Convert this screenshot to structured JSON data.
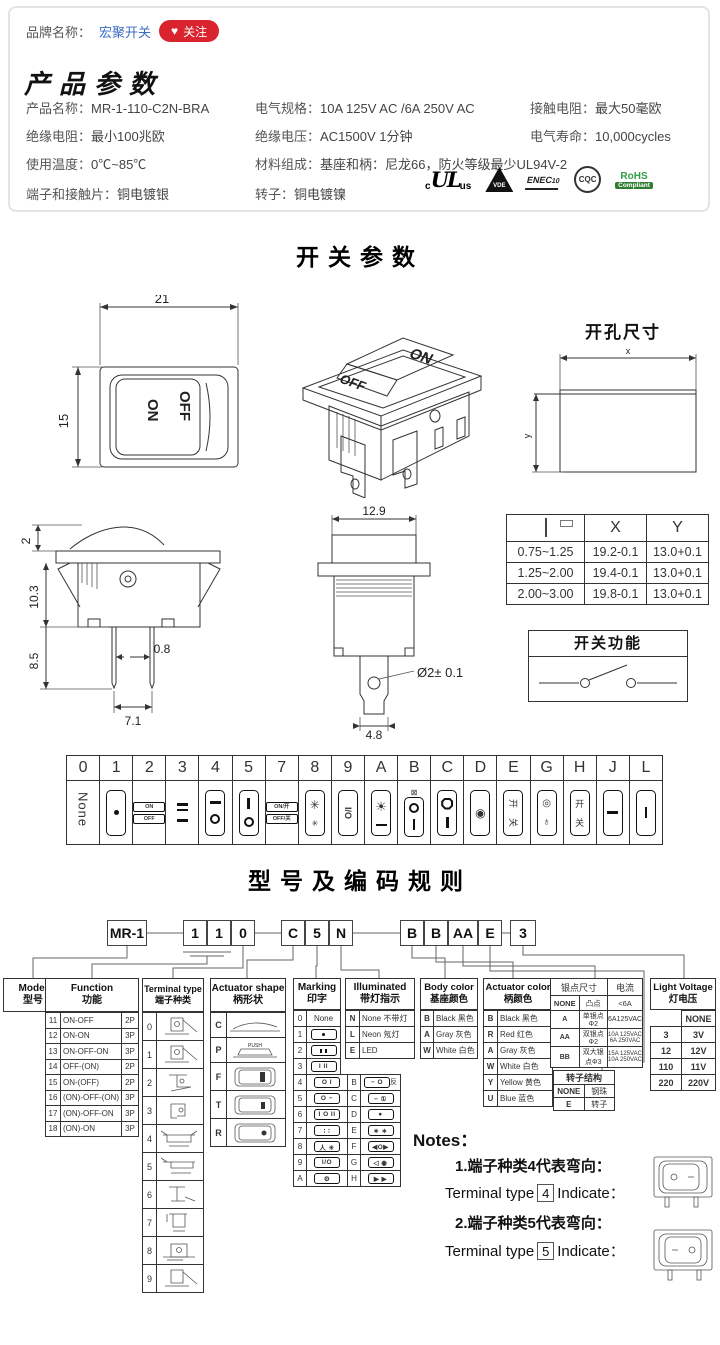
{
  "brand": {
    "label": "品牌名称：",
    "name": "宏聚开关",
    "heart": "♥",
    "follow": "关注"
  },
  "product": {
    "title": "产品参数",
    "specs": [
      {
        "label": "产品名称：",
        "value": "MR-1-110-C2N-BRA"
      },
      {
        "label": "电气规格：",
        "value": "10A 125V AC /6A 250V AC"
      },
      {
        "label": "接触电阻：",
        "value": "最大50毫欧"
      },
      {
        "label": "绝缘电阻：",
        "value": "最小100兆欧"
      },
      {
        "label": "绝缘电压：",
        "value": "AC1500V 1分钟"
      },
      {
        "label": "电气寿命：",
        "value": "10,000cycles"
      },
      {
        "label": "使用温度：",
        "value": "0℃~85℃"
      },
      {
        "label": "材料组成：",
        "value": "基座和柄：尼龙66，防火等级最少UL94V-2"
      },
      {
        "label": "端子和接触片：",
        "value": "铜电镀银"
      },
      {
        "label": "转子：",
        "value": "铜电镀镍"
      }
    ],
    "certs": {
      "c": "c",
      "ul": "UL",
      "us": "us",
      "vde": "VDE",
      "enec": "ENEC",
      "enec10": "10",
      "cqc": "CQC",
      "rohs": "RoHS",
      "compliant": "Compliant"
    }
  },
  "switch_section": {
    "title": "开关参数",
    "front": {
      "w": "21",
      "h": "15",
      "off": "OFF",
      "on": "ON"
    },
    "iso": {
      "on": "ON",
      "off": "OFF"
    },
    "hole": {
      "title": "开孔尺寸",
      "x": "x",
      "y": "y"
    },
    "side": {
      "d2": "2",
      "d103": "10.3",
      "d85": "8.5",
      "d08": "0.8",
      "d71": "7.1"
    },
    "front2": {
      "d129": "12.9",
      "dia": "Ø2± 0.1",
      "d48": "4.8"
    },
    "xy_table": {
      "hx": "X",
      "hy": "Y",
      "rows": [
        [
          "0.75~1.25",
          "19.2-0.1",
          "13.0+0.1"
        ],
        [
          "1.25~2.00",
          "19.4-0.1",
          "13.0+0.1"
        ],
        [
          "2.00~3.00",
          "19.8-0.1",
          "13.0+0.1"
        ]
      ]
    },
    "func_box": {
      "title": "开关功能"
    }
  },
  "marking_table": {
    "headers": [
      "0",
      "1",
      "2",
      "3",
      "4",
      "5",
      "7",
      "8",
      "9",
      "A",
      "B",
      "C",
      "D",
      "E",
      "G",
      "H",
      "J",
      "L"
    ],
    "none": "None",
    "on": "ON",
    "off": "OFF",
    "on7": "ON/开",
    "off7": "OFF/关",
    "fan_big": "✳",
    "fan_small": "✳",
    "io": "I/O",
    "bulb": "☀",
    "bmark": "⊠",
    "kai_rot": "开",
    "guan_rot": "关",
    "gdot": "◎",
    "lamp": "♁",
    "kai": "开",
    "guan": "关",
    "dcircle": "◉"
  },
  "coding": {
    "title": "型号及编码规则",
    "codes": {
      "model": "MR-1",
      "f1": "1",
      "f2": "1",
      "t": "0",
      "a": "C",
      "m": "5",
      "i": "N",
      "b": "B",
      "ac": "B",
      "s": "AA",
      "r": "E",
      "lv": "3"
    },
    "model": {
      "en": "Model",
      "zh": "型号"
    },
    "function": {
      "en": "Function",
      "zh": "功能",
      "rows": [
        [
          "11",
          "ON-OFF",
          "2P"
        ],
        [
          "12",
          "ON-ON",
          "3P"
        ],
        [
          "13",
          "ON-OFF-ON",
          "3P"
        ],
        [
          "14",
          "OFF-(ON)",
          "2P"
        ],
        [
          "15",
          "ON-(OFF)",
          "2P"
        ],
        [
          "16",
          "(ON)-OFF-(ON)",
          "3P"
        ],
        [
          "17",
          "(ON)-OFF-ON",
          "3P"
        ],
        [
          "18",
          "(ON)-ON",
          "3P"
        ]
      ]
    },
    "terminal": {
      "en": "Terminal type",
      "zh": "端子种类",
      "codes": [
        "0",
        "1",
        "2",
        "3",
        "4",
        "5",
        "6",
        "7",
        "8",
        "9"
      ]
    },
    "shape": {
      "en": "Actuator shape",
      "zh": "柄形状",
      "codes": [
        "C",
        "P",
        "F",
        "T",
        "R"
      ],
      "push": "PUSH"
    },
    "marking": {
      "en": "Marking",
      "zh": "印字",
      "rows1": [
        [
          "0",
          "None"
        ],
        [
          "1",
          ""
        ],
        [
          "2",
          ""
        ],
        [
          "3",
          "I II"
        ]
      ],
      "rows2": [
        [
          "4",
          "O I",
          "B",
          "− O",
          "反"
        ],
        [
          "5",
          "O −",
          "C",
          "− ①",
          ""
        ],
        [
          "6",
          "I O II",
          "D",
          "●",
          ""
        ],
        [
          "7",
          "∶ ∶",
          "E",
          "∗ ∗",
          ""
        ],
        [
          "8",
          "人 ✳",
          "F",
          "◀O▶",
          ""
        ],
        [
          "9",
          "I/O",
          "G",
          "◁ ◉",
          ""
        ],
        [
          "A",
          "⚙",
          "H",
          "▶ ▶",
          ""
        ]
      ]
    },
    "illuminated": {
      "en": "Illuminated",
      "zh": "带灯指示",
      "rows": [
        [
          "N",
          "None 不带灯"
        ],
        [
          "L",
          "Neon 氖灯"
        ],
        [
          "E",
          "LED"
        ]
      ]
    },
    "body_color": {
      "en": "Body color",
      "zh": "基座颜色",
      "rows": [
        [
          "B",
          "Black 黑色"
        ],
        [
          "A",
          "Gray 灰色"
        ],
        [
          "W",
          "White 白色"
        ]
      ]
    },
    "actuator_color": {
      "en": "Actuator color",
      "zh": "柄颜色",
      "rows": [
        [
          "B",
          "Black 黑色"
        ],
        [
          "R",
          "Red 红色"
        ],
        [
          "A",
          "Gray 灰色"
        ],
        [
          "W",
          "White 白色"
        ],
        [
          "Y",
          "Yellow 黄色"
        ],
        [
          "U",
          "Blue 蓝色"
        ]
      ]
    },
    "silver": {
      "h1": "银点尺寸",
      "h2": "电流",
      "rows": [
        [
          "NONE",
          "凸点",
          "<6A"
        ],
        [
          "A",
          "单银点Φ2",
          "6A125VAC"
        ],
        [
          "AA",
          "双银点Φ2",
          "10A 125VAC\n6A 250VAC"
        ],
        [
          "BB",
          "双大银点Φ3",
          "15A 125VAC\n10A 250VAC"
        ]
      ]
    },
    "rotor": {
      "title": "转子结构",
      "rows": [
        [
          "NONE",
          "钢珠"
        ],
        [
          "E",
          "转子"
        ]
      ]
    },
    "light": {
      "en": "Light Voltage",
      "zh": "灯电压",
      "rows": [
        [
          "",
          "NONE"
        ],
        [
          "3",
          "3V"
        ],
        [
          "12",
          "12V"
        ],
        [
          "110",
          "11V"
        ],
        [
          "220",
          "220V"
        ]
      ]
    },
    "notes": {
      "title": "Notes：",
      "n1": "1.端子种类4代表弯向：",
      "t1a": "Terminal type",
      "t1b": "4",
      "t1c": "Indicate：",
      "n2": "2.端子种类5代表弯向：",
      "t2a": "Terminal type",
      "t2b": "5",
      "t2c": "Indicate："
    }
  }
}
